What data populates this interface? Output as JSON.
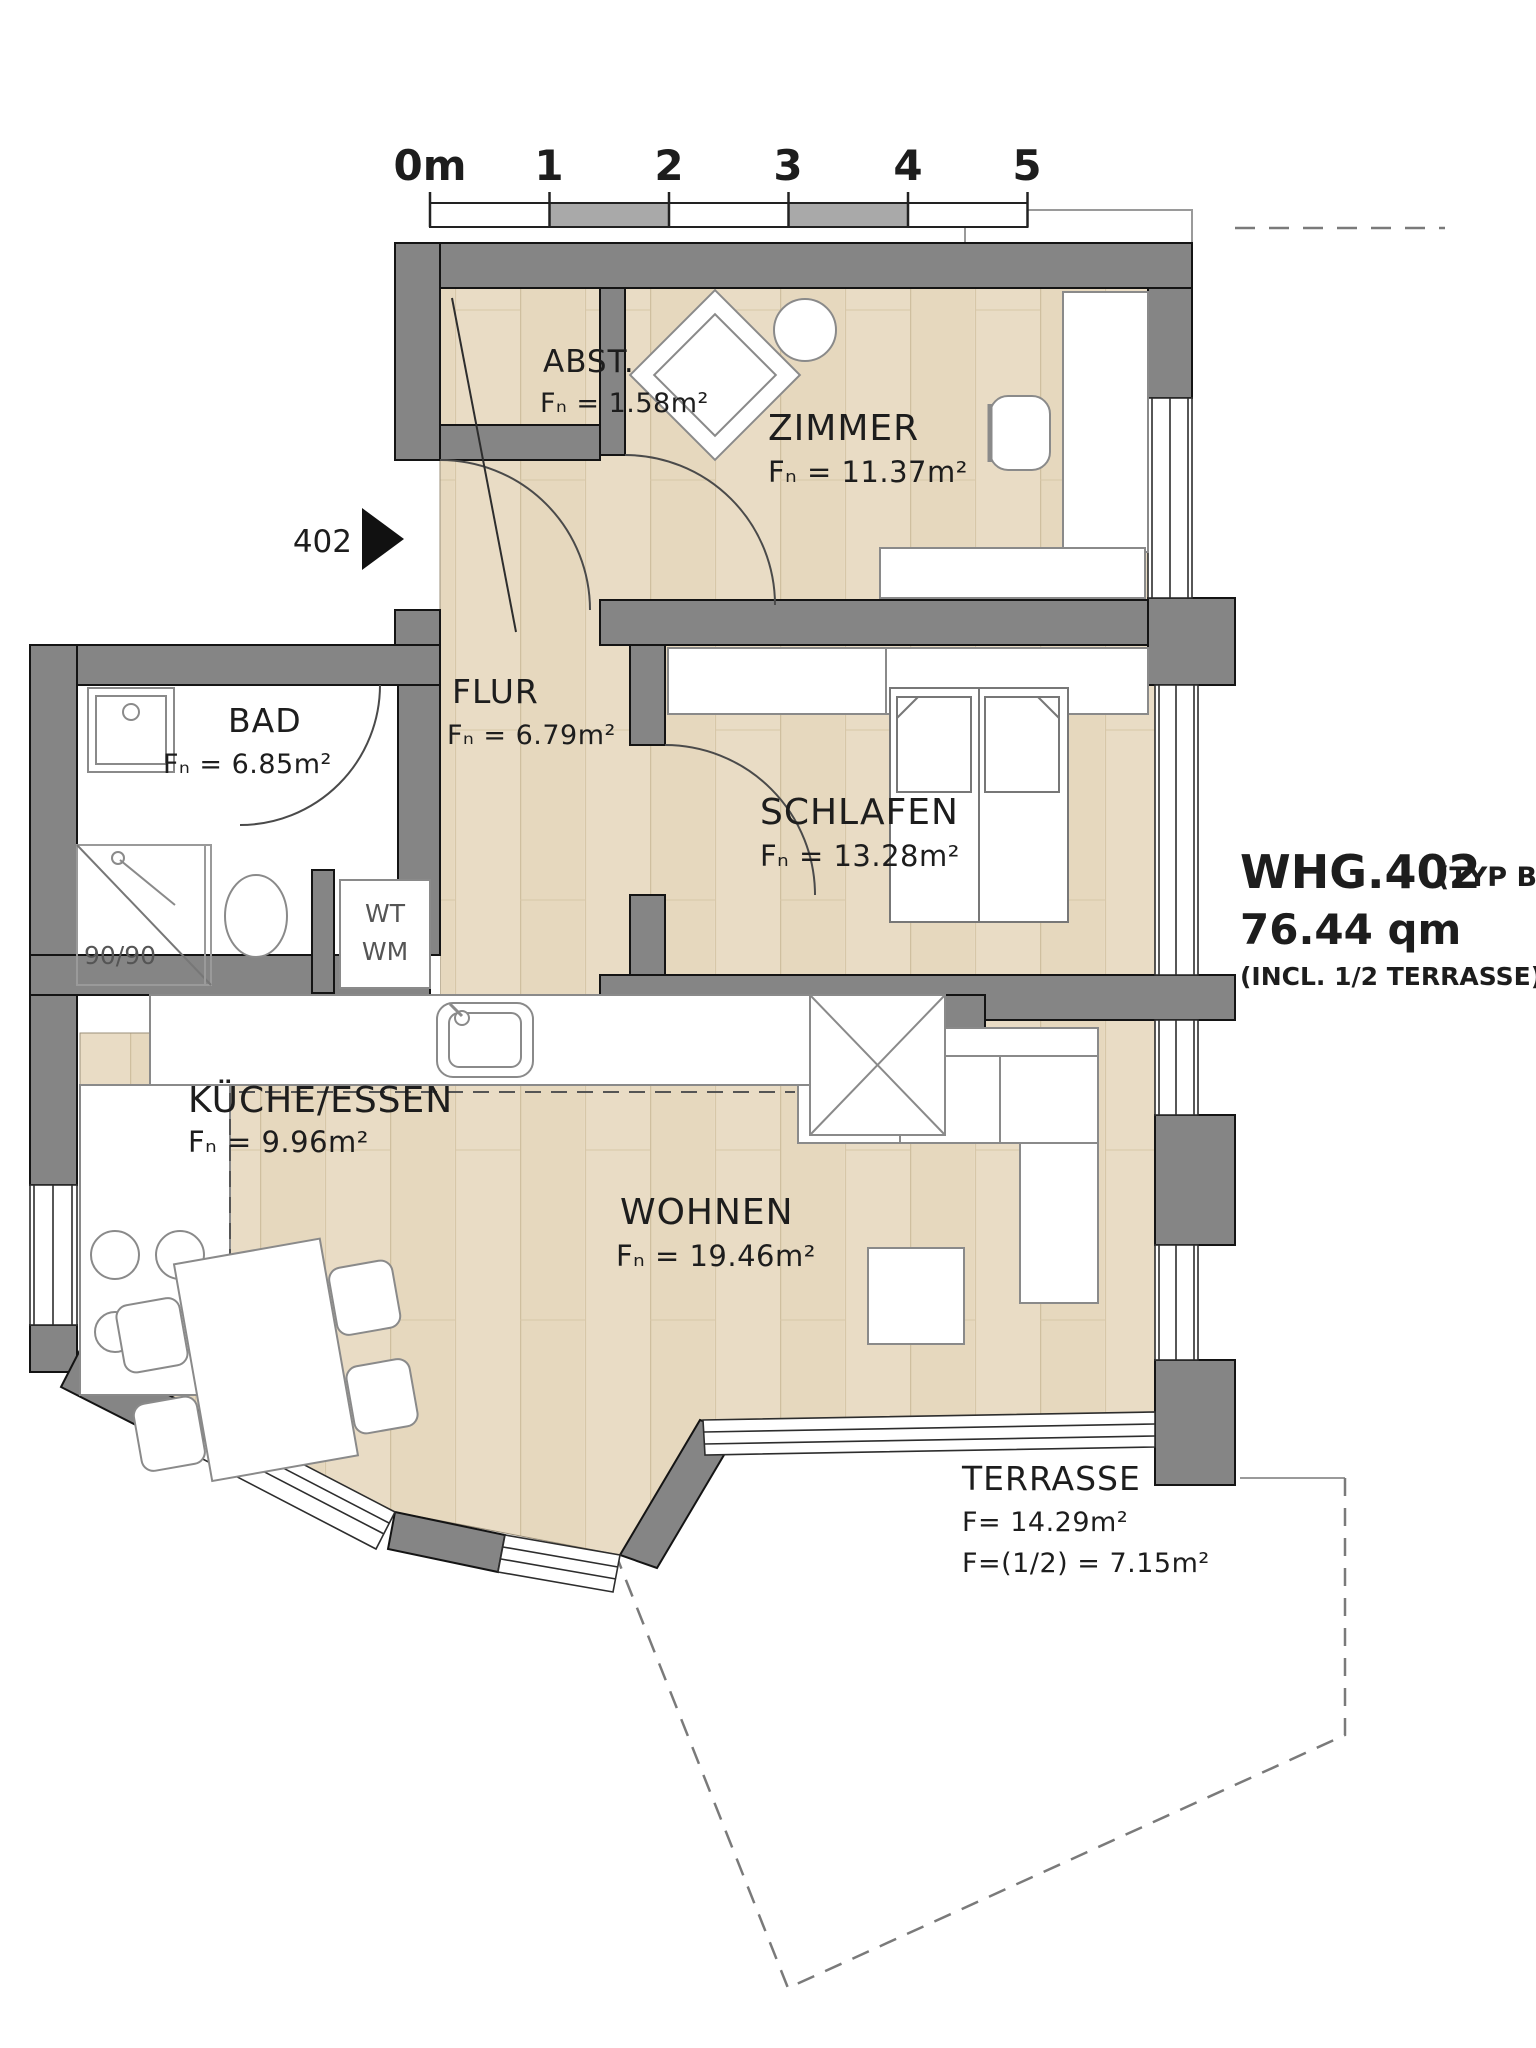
{
  "plan": {
    "scale_bar": {
      "labels": [
        "0m",
        "1",
        "2",
        "3",
        "4",
        "5"
      ]
    },
    "unit_marker": "402",
    "title": {
      "name": "WHG.402",
      "type": "(TYP B)",
      "area": "76.44 qm",
      "note": "(INCL. 1/2 TERRASSE)"
    },
    "rooms": {
      "abst": {
        "name": "ABST.",
        "area": "Fₙ = 1.58m²"
      },
      "zimmer": {
        "name": "ZIMMER",
        "area": "Fₙ = 11.37m²"
      },
      "flur": {
        "name": "FLUR",
        "area": "Fₙ = 6.79m²"
      },
      "bad": {
        "name": "BAD",
        "area": "Fₙ = 6.85m²"
      },
      "schlafen": {
        "name": "SCHLAFEN",
        "area": "Fₙ = 13.28m²"
      },
      "kueche": {
        "name": "KÜCHE/ESSEN",
        "area": "Fₙ = 9.96m²"
      },
      "wohnen": {
        "name": "WOHNEN",
        "area": "Fₙ = 19.46m²"
      },
      "terrasse": {
        "name": "TERRASSE",
        "area": "F= 14.29m²",
        "area_half": "F=(1/2) = 7.15m²"
      }
    },
    "fixtures": {
      "shower_size": "90/90",
      "wt": "WT",
      "wm": "WM"
    },
    "colors": {
      "wall": "#858585",
      "floor": "#e9dcc5",
      "line": "#1a1a1a"
    }
  }
}
